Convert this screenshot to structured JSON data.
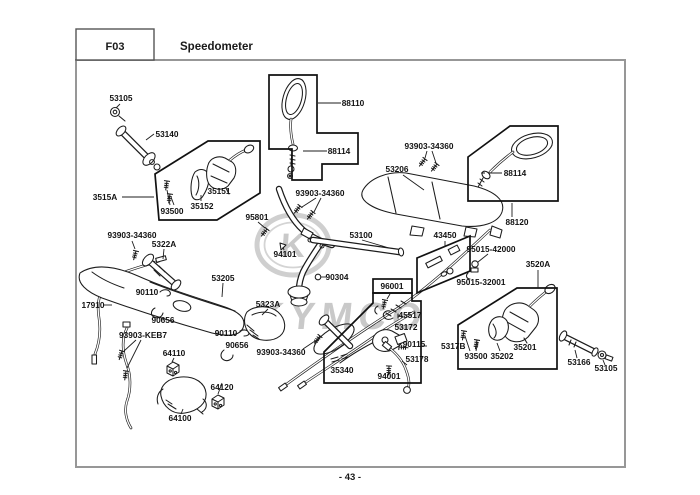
{
  "header": {
    "code": "F03",
    "title": "Speedometer"
  },
  "footer": {
    "page_number": "- 43 -"
  },
  "watermark": {
    "monogram": "K",
    "brand": "KYMCO"
  },
  "diagram": {
    "part_labels": [
      "53105",
      "53140",
      "3515A",
      "93500",
      "35152",
      "35151",
      "88110",
      "88114",
      "93903-34360",
      "93903-34360",
      "53206",
      "88114",
      "88120",
      "95801",
      "53100",
      "94101",
      "90304",
      "93903-34360",
      "5322A",
      "53205",
      "17910",
      "90110",
      "90656",
      "5323A",
      "93903-KEB7",
      "64110",
      "90110",
      "90656",
      "93903-34360",
      "64120",
      "64100",
      "96001",
      "45517",
      "53172",
      "90115",
      "53178",
      "94001",
      "35340",
      "5317B",
      "43450",
      "95015-42000",
      "95015-32001",
      "3520A",
      "35201",
      "93500",
      "35202",
      "53166",
      "53105"
    ]
  }
}
